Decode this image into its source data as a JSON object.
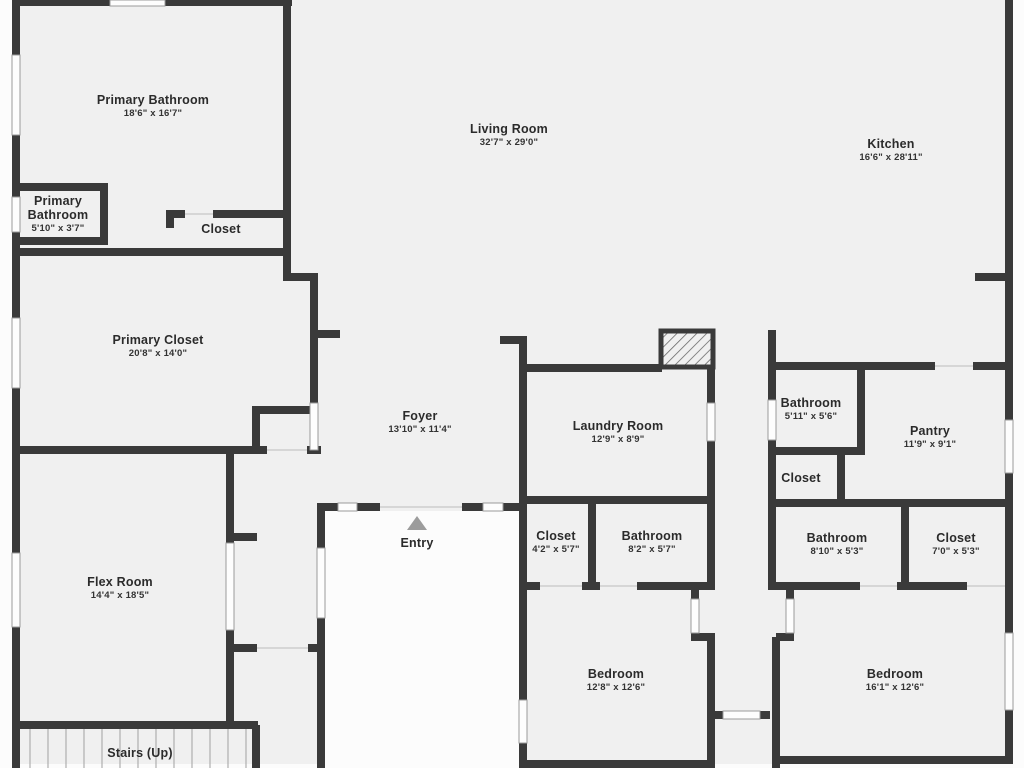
{
  "plan": {
    "type": "floor-plan",
    "colors": {
      "wall": "#3a3a3a",
      "room_fill": "#f0f0f0",
      "outside_fill": "#fcfcfc",
      "window_fill": "#fdfdfd",
      "window_frame": "#9a9a9a",
      "door_line": "#d6d6d6",
      "entry_marker": "#9c9c9c",
      "stair_tread": "#b4b4b4",
      "label_text": "#2b2b2b"
    },
    "icons": {
      "entry_marker": "triangle-up-icon",
      "fireplace": "hatched-box-icon"
    },
    "rooms": [
      {
        "name": "Primary Bathroom",
        "dims": "18'6\" x 16'7\"",
        "x": 153,
        "y": 106,
        "w": 220
      },
      {
        "name": "Primary Bathroom",
        "dims": "5'10\" x 3'7\"",
        "x": 58,
        "y": 214,
        "w": 78
      },
      {
        "name": "Closet",
        "dims": "",
        "x": 221,
        "y": 229,
        "w": 110
      },
      {
        "name": "Living Room",
        "dims": "32'7\" x 29'0\"",
        "x": 509,
        "y": 135,
        "w": 220
      },
      {
        "name": "Kitchen",
        "dims": "16'6\" x 28'11\"",
        "x": 891,
        "y": 150,
        "w": 220
      },
      {
        "name": "Primary Closet",
        "dims": "20'8\" x 14'0\"",
        "x": 158,
        "y": 346,
        "w": 220
      },
      {
        "name": "Foyer",
        "dims": "13'10\" x 11'4\"",
        "x": 420,
        "y": 422,
        "w": 220
      },
      {
        "name": "Laundry Room",
        "dims": "12'9\" x 8'9\"",
        "x": 618,
        "y": 432,
        "w": 220
      },
      {
        "name": "Bathroom",
        "dims": "5'11\" x 5'6\"",
        "x": 811,
        "y": 409,
        "w": 130
      },
      {
        "name": "Pantry",
        "dims": "11'9\" x 9'1\"",
        "x": 930,
        "y": 437,
        "w": 150
      },
      {
        "name": "Closet",
        "dims": "",
        "x": 801,
        "y": 478,
        "w": 110
      },
      {
        "name": "Closet",
        "dims": "4'2\" x 5'7\"",
        "x": 556,
        "y": 542,
        "w": 95
      },
      {
        "name": "Bathroom",
        "dims": "8'2\" x 5'7\"",
        "x": 652,
        "y": 542,
        "w": 130
      },
      {
        "name": "Bathroom",
        "dims": "8'10\" x 5'3\"",
        "x": 837,
        "y": 544,
        "w": 130
      },
      {
        "name": "Closet",
        "dims": "7'0\" x 5'3\"",
        "x": 956,
        "y": 544,
        "w": 120
      },
      {
        "name": "Flex Room",
        "dims": "14'4\" x 18'5\"",
        "x": 120,
        "y": 588,
        "w": 170
      },
      {
        "name": "Entry",
        "dims": "",
        "x": 417,
        "y": 543,
        "w": 110
      },
      {
        "name": "Bedroom",
        "dims": "12'8\" x 12'6\"",
        "x": 616,
        "y": 680,
        "w": 170
      },
      {
        "name": "Bedroom",
        "dims": "16'1\" x 12'6\"",
        "x": 895,
        "y": 680,
        "w": 170
      },
      {
        "name": "Stairs (Up)",
        "dims": "",
        "x": 140,
        "y": 753,
        "w": 170
      }
    ]
  }
}
